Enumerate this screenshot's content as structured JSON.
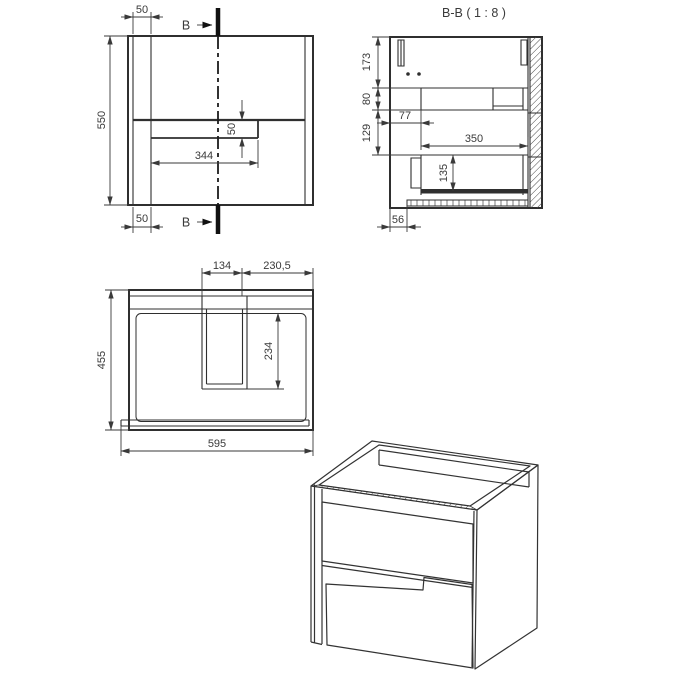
{
  "drawing": {
    "background": "#ffffff",
    "line_color": "#2f2f2f",
    "text_color": "#3a3a3a",
    "front_view": {
      "section_letter_top": "B",
      "section_letter_bottom": "B",
      "dim_panel_offset_top": "50",
      "dim_height": "550",
      "dim_groove_width": "344",
      "dim_groove_height": "50",
      "dim_panel_offset_bottom": "50"
    },
    "section_view": {
      "title": "B-B ( 1 : 8 )",
      "dim_top_clearance": "173",
      "dim_apron_height": "80",
      "dim_middle_clearance": "129",
      "dim_back_gap": "77",
      "dim_drawer_depth": "350",
      "dim_drawer_inner_height": "135",
      "dim_plinth_setback": "56"
    },
    "top_view": {
      "dim_cutout_width": "134",
      "dim_edge_distance": "230,5",
      "dim_depth": "455",
      "dim_cutout_depth": "234",
      "dim_width": "595"
    }
  }
}
